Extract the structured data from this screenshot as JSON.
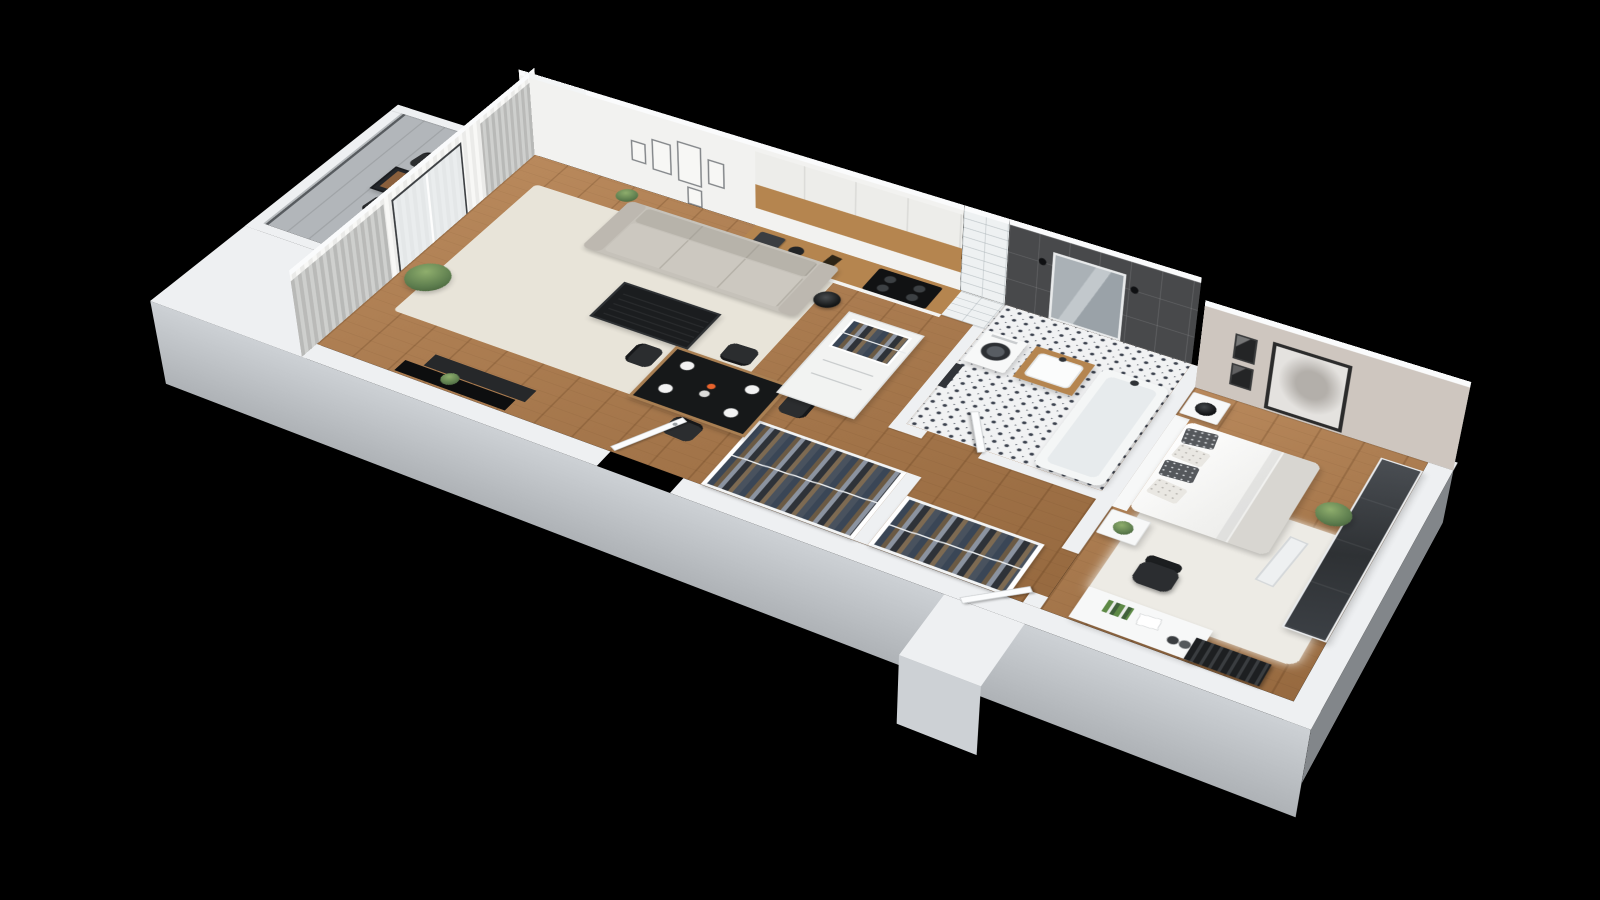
{
  "scene": {
    "kind": "3d-isometric-floor-plan-render",
    "background": "#000000",
    "labels": {
      "apartment": "apartment 3d floor plan",
      "balcony": "balcony",
      "living_room": "living room",
      "kitchen": "kitchenette",
      "hallway": "hallway",
      "bathroom": "bathroom",
      "bedroom": "bedroom"
    }
  },
  "apartment": {
    "rooms": [
      {
        "id": "balcony",
        "name": "balcony",
        "furniture": [
          "bistro-table",
          "outdoor-chair",
          "outdoor-chair"
        ]
      },
      {
        "id": "living-room",
        "name": "living room",
        "furniture": [
          "sofa",
          "area-rug",
          "coffee-table",
          "floor-lamp",
          "tv-panel",
          "media-bench",
          "dining-table",
          "dining-chair-x4",
          "curtains",
          "balcony-glass-door",
          "gallery-wall-frames",
          "potted-palm",
          "small-plants"
        ]
      },
      {
        "id": "kitchen",
        "name": "kitchenette",
        "furniture": [
          "base-cabinets",
          "wood-countertop",
          "cooktop",
          "coffee-machine",
          "kettle",
          "upper-cabinets"
        ]
      },
      {
        "id": "hallway",
        "name": "hallway",
        "furniture": [
          "wardrobe-cabinet-open-top",
          "clothes-rack",
          "clothes-rack",
          "entrance-door"
        ]
      },
      {
        "id": "bathroom",
        "name": "bathroom",
        "furniture": [
          "washing-machine",
          "vanity-with-sink",
          "mirror-with-sconces",
          "bathtub",
          "towel",
          "patterned-tile-floor",
          "dark-wall-tiles",
          "tiled-duct-column",
          "bathroom-door"
        ]
      },
      {
        "id": "bedroom",
        "name": "bedroom",
        "furniture": [
          "double-bed",
          "headboard",
          "pillows",
          "nightstand-with-lamp",
          "nightstand-with-plant",
          "shag-rug",
          "desk",
          "office-chair",
          "sliding-wardrobe",
          "radiator",
          "leaning-mirror",
          "portrait-art",
          "niche-frames",
          "potted-plant",
          "bedroom-door"
        ]
      }
    ]
  },
  "labels": {
    "sofa": "sofa",
    "coffee_table": "coffee table",
    "dining_table": "dining table with tableware",
    "tv": "television panel",
    "kitchen_counter": "kitchen counter with cooktop",
    "wardrobe_cabinet": "hall wardrobe cabinet with clothes",
    "clothes_rack_a": "open clothes rack",
    "clothes_rack_b": "open clothes rack",
    "entrance_door": "entrance door (open)",
    "washing_machine": "washing machine",
    "vanity": "bath vanity with sink",
    "bathtub": "bathtub",
    "mirror": "bathroom mirror with sconces",
    "bed": "double bed",
    "desk": "desk with chair",
    "wardrobe_bedroom": "sliding-door wardrobe",
    "radiator": "radiator",
    "balcony_table": "balcony bistro set",
    "portrait": "portrait wall art",
    "gallery": "gallery wall frames"
  },
  "palette": {
    "bg": "#000000",
    "wallTop": "#fafbfc",
    "wallFace": "#eef0f2",
    "wallOuterLight": "#cdd1d5",
    "wallOuterDark": "#aeb2b6",
    "wood": "#b9895c",
    "woodDark": "#96693f",
    "counterWood": "#b5854f",
    "rugLiving": "#e8e4d9",
    "rugBedroom": "#edebe5",
    "sofa": "#c6c2ba",
    "darkFurn": "#1d1f21",
    "chairDark": "#2b2d2f",
    "tileDark": "#48494b",
    "tileLight": "#f1f2f3",
    "patternDot": "#3e4450",
    "greige": "#cec6bf",
    "glass": "#dfe4e7",
    "green": "#5d7d4e",
    "white": "#f7f8f8",
    "balcony": "#b2b6ba",
    "radiator": "#27292b"
  }
}
